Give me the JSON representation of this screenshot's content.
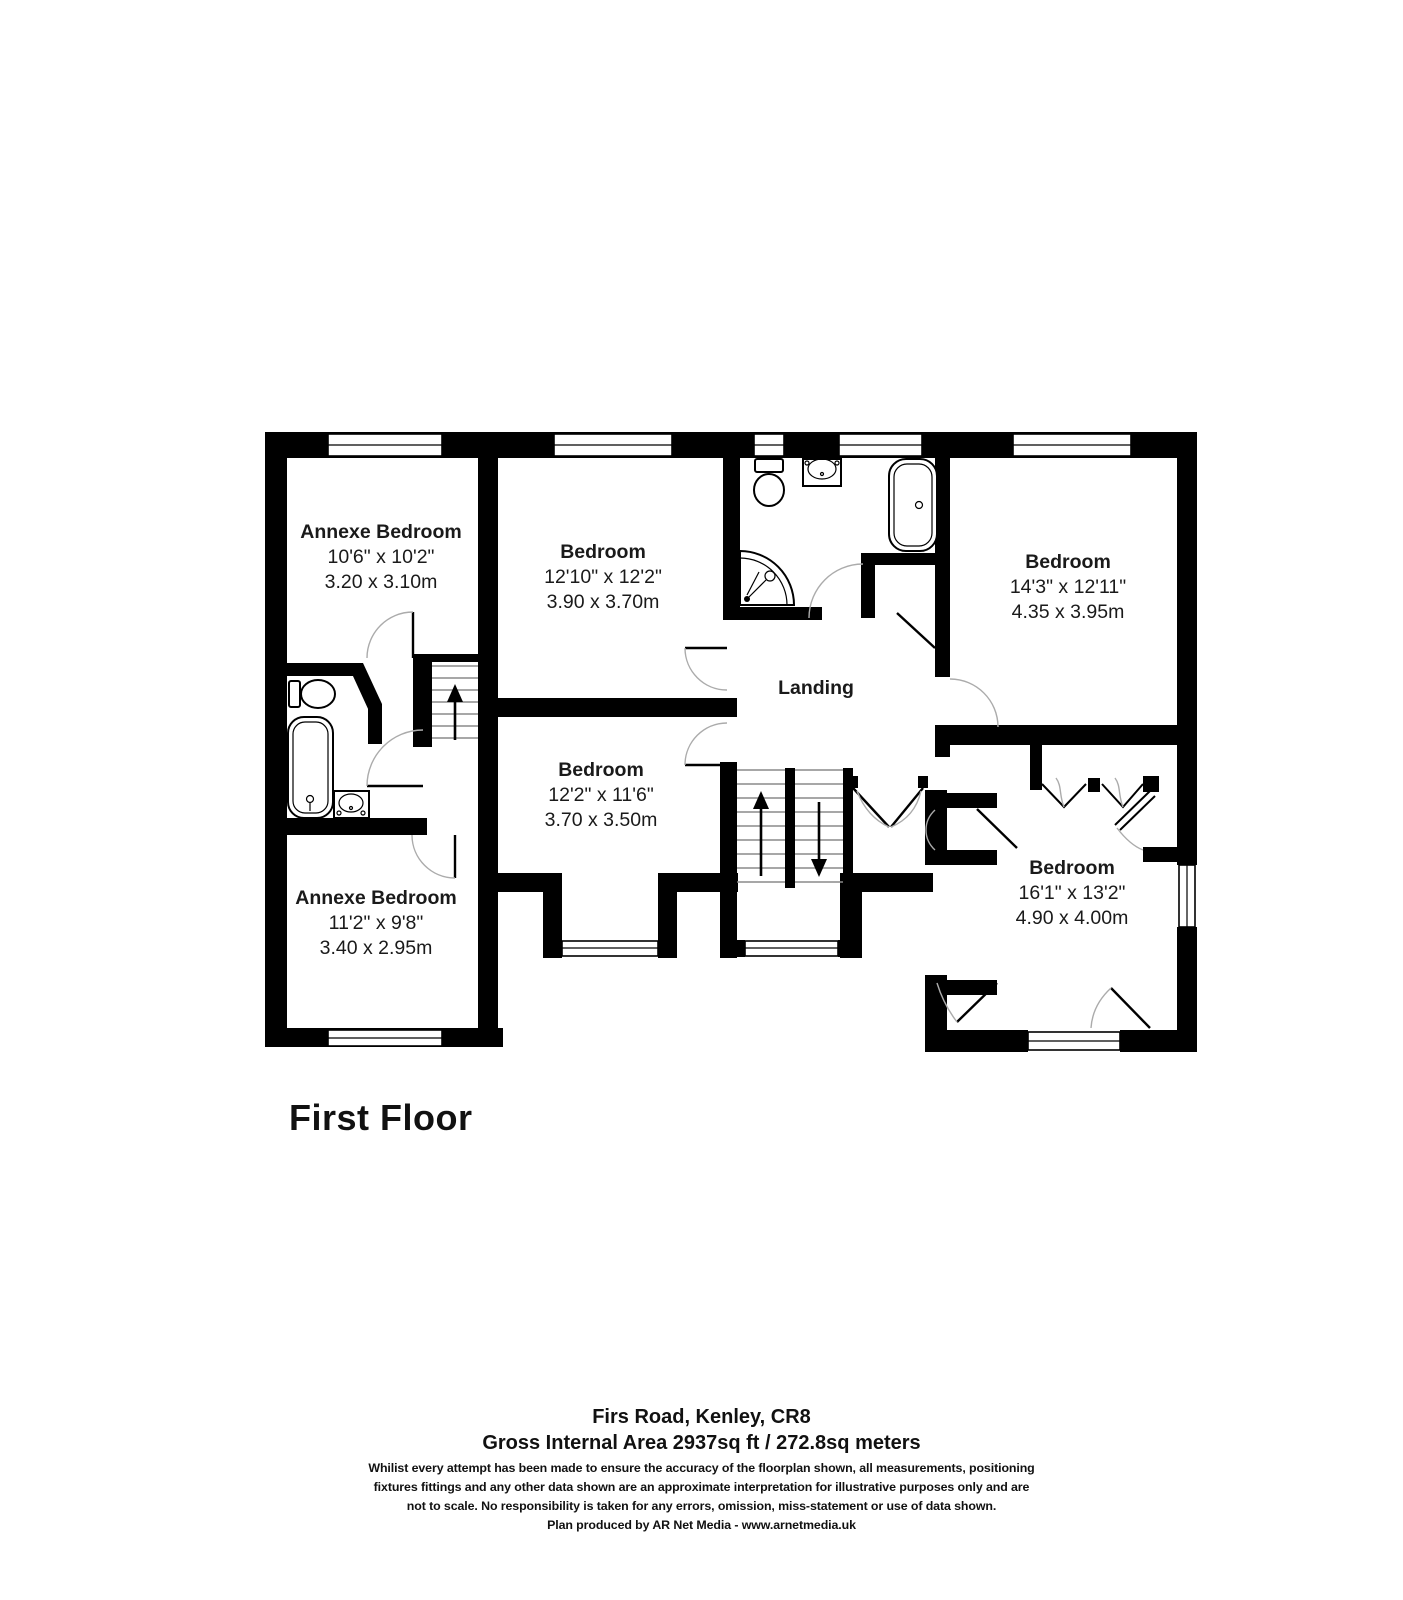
{
  "colors": {
    "wall": "#000000",
    "background": "#ffffff",
    "text": "#1a1a1a",
    "door_arc": "#ababab",
    "stair_tread": "#8a8a8a"
  },
  "floor_title": "First Floor",
  "rooms": [
    {
      "name": "Annexe Bedroom",
      "imperial": "10'6\" x 10'2\"",
      "metric": "3.20 x 3.10m"
    },
    {
      "name": "Bedroom",
      "imperial": "12'10\" x 12'2\"",
      "metric": "3.90 x 3.70m"
    },
    {
      "name": "Bedroom",
      "imperial": "14'3\" x 12'11\"",
      "metric": "4.35 x 3.95m"
    },
    {
      "name": "Landing"
    },
    {
      "name": "Bedroom",
      "imperial": "12'2\" x 11'6\"",
      "metric": "3.70 x 3.50m"
    },
    {
      "name": "Annexe Bedroom",
      "imperial": "11'2\" x 9'8\"",
      "metric": "3.40 x 2.95m"
    },
    {
      "name": "Bedroom",
      "imperial": "16'1\" x 13'2\"",
      "metric": "4.90 x 4.00m"
    }
  ],
  "footer": {
    "address": "Firs Road, Kenley, CR8",
    "area": "Gross Internal Area 2937sq ft / 272.8sq meters",
    "disclaimer_lines": [
      "Whilist every attempt has been made to ensure the accuracy of the floorplan shown, all measurements, positioning",
      "fixtures fittings and any other data shown are an approximate interpretation for illustrative purposes only and are",
      "not to scale. No responsibility is taken for any errors, omission, miss-statement or use of data shown."
    ],
    "credit": "Plan produced by AR Net Media - www.arnetmedia.uk"
  }
}
